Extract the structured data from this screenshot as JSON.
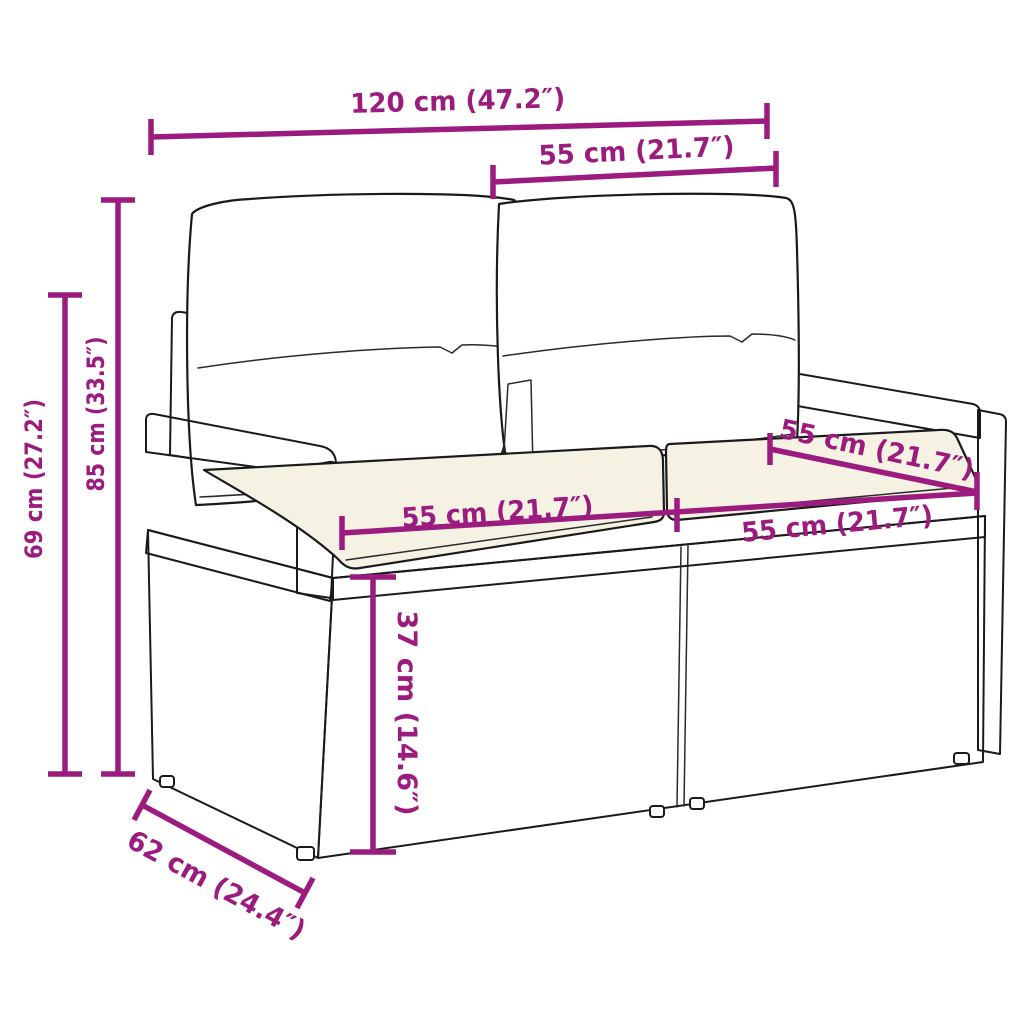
{
  "figure": {
    "title": "Garden sofa dimension diagram",
    "subject": "2-seater poly rattan garden sofa with back and seat cushions",
    "accent_color": "#9B1B7E",
    "line_color": "#1a1a1a",
    "back_cushion_color": "#ffffff",
    "seat_cushion_color": "#f5f2e4",
    "background_color": "#ffffff"
  },
  "dimensions": {
    "overall_width": {
      "label": "120 cm (47.2″)",
      "cm": 120,
      "inches": 47.2
    },
    "seat_width_top": {
      "label": "55 cm (21.7″)",
      "cm": 55,
      "inches": 21.7
    },
    "total_height": {
      "label": "85 cm (33.5″)",
      "cm": 85,
      "inches": 33.5
    },
    "armrest_height": {
      "label": "69 cm (27.2″)",
      "cm": 69,
      "inches": 27.2
    },
    "back_rail_width": {
      "label": "55 cm (21.7″)",
      "cm": 55,
      "inches": 21.7
    },
    "left_seat_width": {
      "label": "55 cm (21.7″)",
      "cm": 55,
      "inches": 21.7
    },
    "right_seat_width": {
      "label": "55 cm (21.7″)",
      "cm": 55,
      "inches": 21.7
    },
    "seat_height": {
      "label": "37 cm (14.6″)",
      "cm": 37,
      "inches": 14.6
    },
    "depth": {
      "label": "62 cm (24.4″)",
      "cm": 62,
      "inches": 24.4
    }
  }
}
